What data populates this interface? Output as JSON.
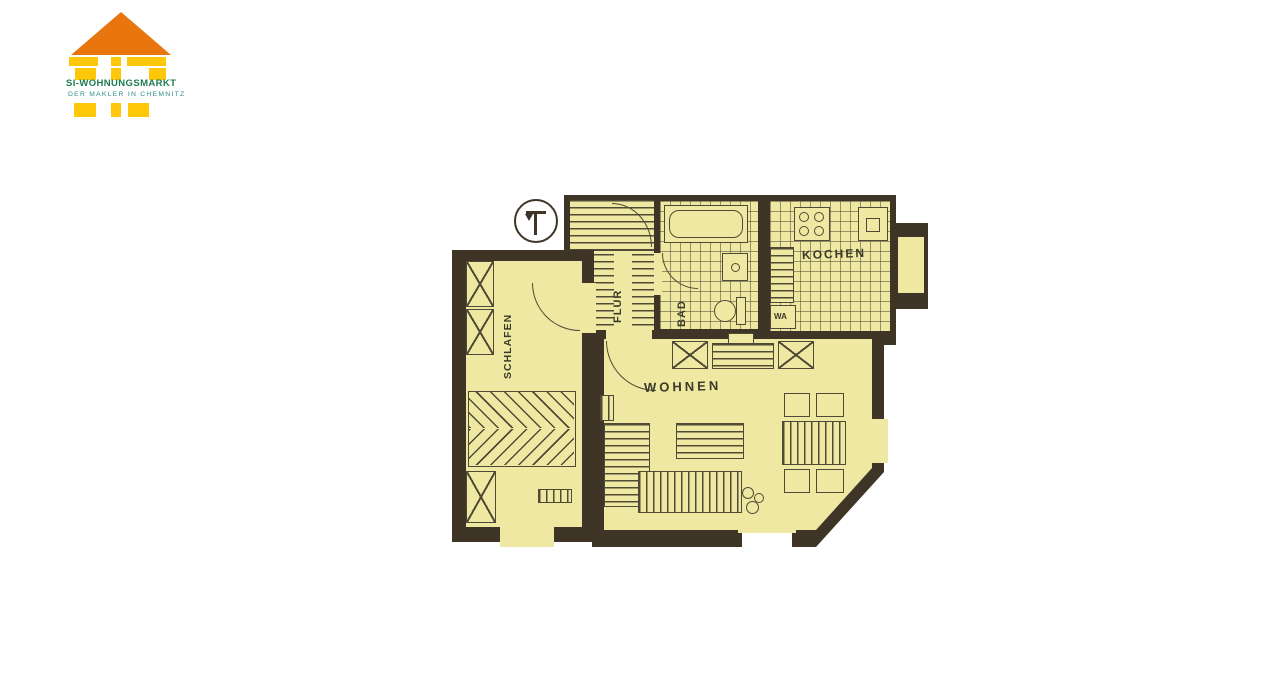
{
  "logo": {
    "title": "SI-WOHNUNGSMARKT",
    "subtitle": "DER MAKLER IN CHEMNITZ",
    "colors": {
      "roof": "#E8750E",
      "pillars": "#FEC70A",
      "title": "#1E7B4F",
      "subtitle": "#2F8C8C"
    }
  },
  "floor_plan": {
    "rooms": [
      {
        "id": "schlafen",
        "label": "SCHLAFEN",
        "orientation": "vertical"
      },
      {
        "id": "flur",
        "label": "FLUR",
        "orientation": "vertical"
      },
      {
        "id": "bad",
        "label": "BAD",
        "orientation": "vertical"
      },
      {
        "id": "kochen",
        "label": "KOCHEN",
        "orientation": "horizontal"
      },
      {
        "id": "wa",
        "label": "WA",
        "orientation": "horizontal"
      },
      {
        "id": "wohnen",
        "label": "WOHNEN",
        "orientation": "horizontal"
      }
    ],
    "colors": {
      "wall": "#3E3527",
      "floor": "#EFE8A3",
      "stroke": "#4F4A35"
    },
    "symbols": [
      "north-circle",
      "building-stairs",
      "door-arcs",
      "wardrobe-x",
      "double-bed",
      "radiator",
      "bathtub",
      "wc",
      "washbasin",
      "stove",
      "kitchen-sink",
      "washing-machine",
      "sideboard",
      "desk",
      "coffee-table",
      "corner-sofa",
      "dining-table",
      "chairs",
      "plant",
      "windows"
    ]
  }
}
